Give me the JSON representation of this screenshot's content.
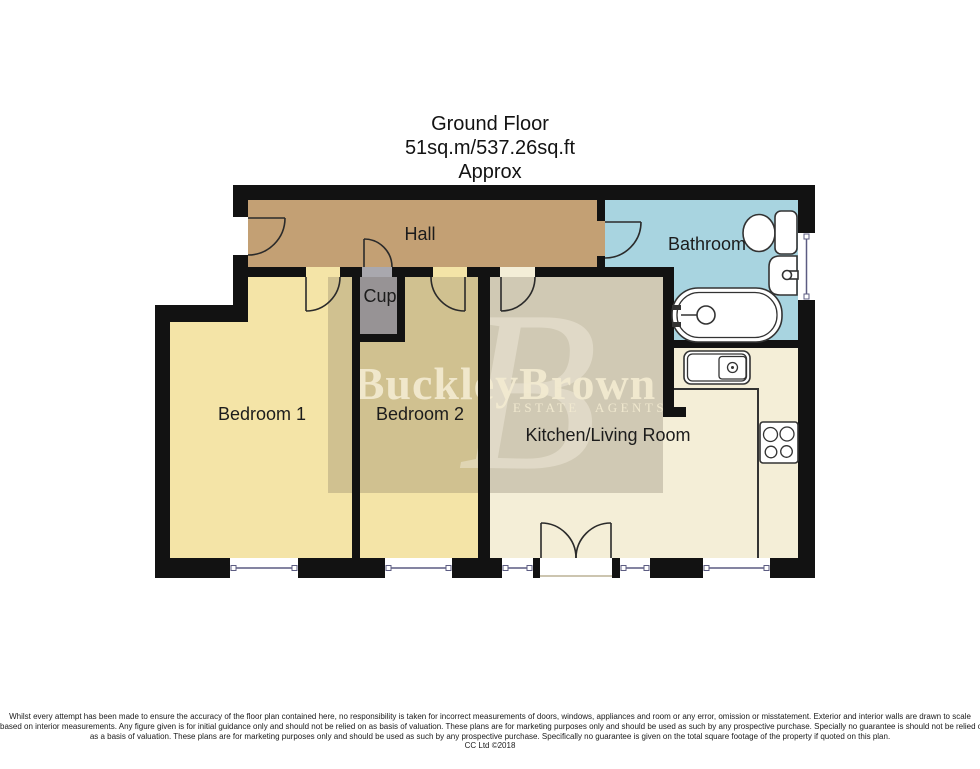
{
  "title": {
    "floor": "Ground Floor",
    "area": "51sq.m/537.26sq.ft",
    "approx": "Approx"
  },
  "rooms": {
    "hall": {
      "label": "Hall"
    },
    "bathroom": {
      "label": "Bathroom"
    },
    "cupboard": {
      "label": "Cup"
    },
    "bedroom1": {
      "label": "Bedroom 1"
    },
    "bedroom2": {
      "label": "Bedroom 2"
    },
    "kitchen_living": {
      "label": "Kitchen/Living Room"
    }
  },
  "watermark": {
    "brand": "BuckleyBrown",
    "tagline": "ESTATE AGENTS",
    "monogram": "B"
  },
  "disclaimer": {
    "line1": "Whilst every attempt has been made to ensure the accuracy of the floor plan contained here, no responsibility is taken for incorrect measurements of doors, windows, appliances and room or any error, omission or misstatement. Exterior and interior walls are drawn to scale",
    "line2": "based on interior measurements. Any figure given is for initial guidance only and should not be relied on as basis of valuation. These plans are for marketing purposes only and should be used as such by any prospective purchase. Specially no guarantee is should not be relied on",
    "line3": "as a basis of valuation. These plans are for marketing purposes only and should be used as such by any prospective purchase. Specifically no guarantee is given on the total square footage of the property if quoted on this plan.",
    "line4": "CC Ltd ©2018"
  },
  "colors": {
    "wall": "#121212",
    "hall": "#c3a074",
    "bedroom": "#f4e4a7",
    "kitchen": "#f4eed7",
    "bathroom": "#a8d4e0",
    "cupboard": "#a9a8ae",
    "overlay": "rgba(95,85,70,0.24)",
    "logo_text": "rgba(242,234,208,0.92)",
    "logo_monogram": "rgba(244,238,222,0.45)",
    "window_line": "#5c5c82"
  }
}
